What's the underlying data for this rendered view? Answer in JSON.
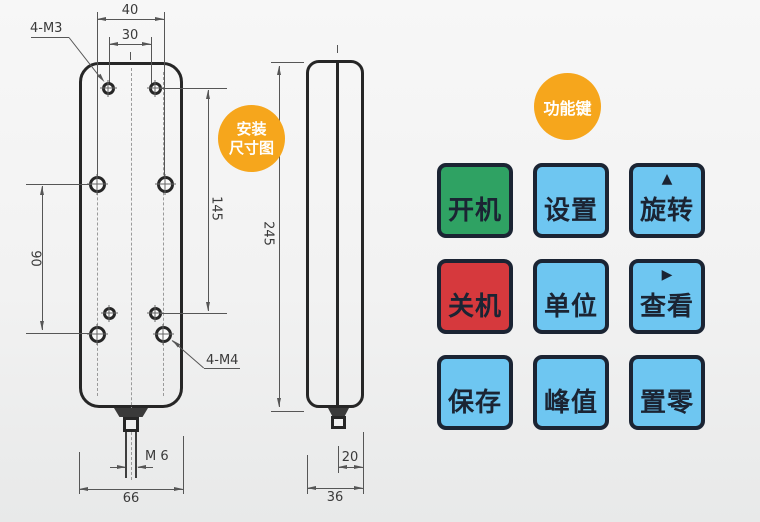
{
  "badges": {
    "install": {
      "line1": "安装",
      "line2": "尺寸图",
      "color": "#F6A61C",
      "text_color": "#FFFFFF"
    },
    "function": {
      "label": "功能键",
      "color": "#F6A61C",
      "text_color": "#FFFFFF"
    }
  },
  "drawing": {
    "front_view": {
      "hole_label_top": "4-M3",
      "hole_label_bottom": "4-M4",
      "thread_label": "M 6",
      "dim_hole_span_outer": "40",
      "dim_hole_span_inner": "30",
      "dim_hole_vertical_right": "145",
      "dim_hole_vertical_left": "90",
      "dim_width": "66"
    },
    "side_view": {
      "dim_height": "245",
      "dim_lower_depth": "20",
      "dim_depth": "36"
    },
    "line_color": "#565656",
    "body_color": "#262626"
  },
  "keys": {
    "border_color": "#1B2433",
    "text_color": "#1B2433",
    "cells": [
      {
        "label": "开机",
        "bg": "#2FA263"
      },
      {
        "label": "设置",
        "bg": "#6EC6F1"
      },
      {
        "label": "旋转",
        "arrow": "▲",
        "bg": "#6EC6F1"
      },
      {
        "label": "关机",
        "bg": "#D6393D"
      },
      {
        "label": "单位",
        "bg": "#6EC6F1"
      },
      {
        "label": "查看",
        "arrow": "▶",
        "bg": "#6EC6F1"
      },
      {
        "label": "保存",
        "bg": "#6EC6F1"
      },
      {
        "label": "峰值",
        "bg": "#6EC6F1"
      },
      {
        "label": "置零",
        "bg": "#6EC6F1"
      }
    ]
  }
}
